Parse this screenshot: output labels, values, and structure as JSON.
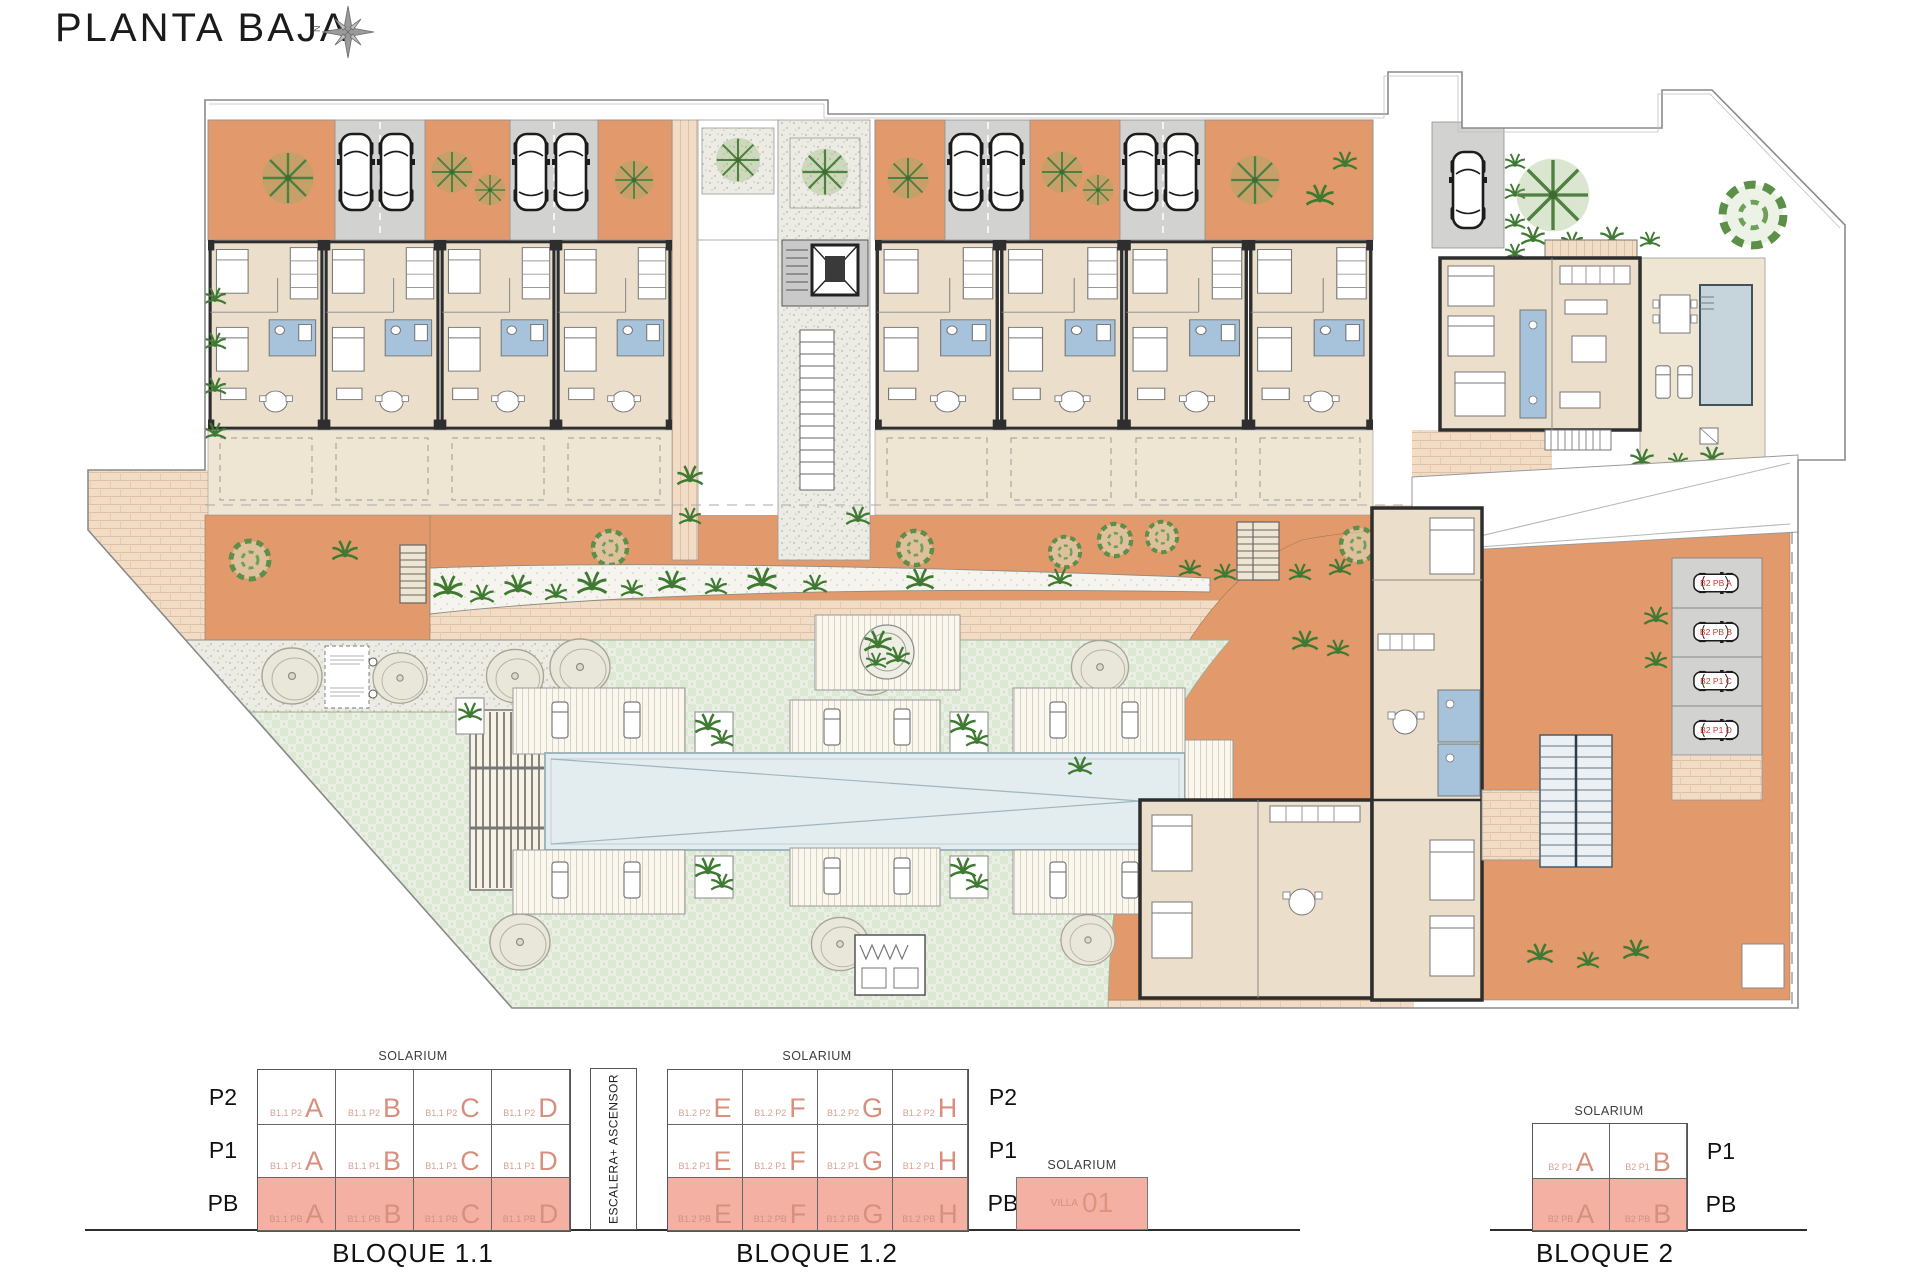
{
  "header": {
    "title": "PLANTA BAJA",
    "compass": "N"
  },
  "site": {
    "parking_labels": [
      "B2 PB A",
      "B2 PB B",
      "B2 P1 C",
      "B2 P1 D"
    ]
  },
  "legend": {
    "solarium": "SOLARIUM",
    "escalera": "ESCALERA+ ASCENSOR",
    "floors": {
      "p2": "P2",
      "p1": "P1",
      "pb": "PB"
    },
    "bloque11": {
      "title": "BLOQUE 1.1",
      "rows": [
        {
          "floor": "P2",
          "cells": [
            {
              "code": "B1.1 P2",
              "letter": "A"
            },
            {
              "code": "B1.1 P2",
              "letter": "B"
            },
            {
              "code": "B1.1 P2",
              "letter": "C"
            },
            {
              "code": "B1.1 P2",
              "letter": "D"
            }
          ]
        },
        {
          "floor": "P1",
          "cells": [
            {
              "code": "B1.1 P1",
              "letter": "A"
            },
            {
              "code": "B1.1 P1",
              "letter": "B"
            },
            {
              "code": "B1.1 P1",
              "letter": "C"
            },
            {
              "code": "B1.1 P1",
              "letter": "D"
            }
          ]
        },
        {
          "floor": "PB",
          "cells": [
            {
              "code": "B1.1 PB",
              "letter": "A"
            },
            {
              "code": "B1.1 PB",
              "letter": "B"
            },
            {
              "code": "B1.1 PB",
              "letter": "C"
            },
            {
              "code": "B1.1 PB",
              "letter": "D"
            }
          ]
        }
      ]
    },
    "bloque12": {
      "title": "BLOQUE 1.2",
      "rows": [
        {
          "floor": "P2",
          "cells": [
            {
              "code": "B1.2 P2",
              "letter": "E"
            },
            {
              "code": "B1.2 P2",
              "letter": "F"
            },
            {
              "code": "B1.2 P2",
              "letter": "G"
            },
            {
              "code": "B1.2 P2",
              "letter": "H"
            }
          ]
        },
        {
          "floor": "P1",
          "cells": [
            {
              "code": "B1.2 P1",
              "letter": "E"
            },
            {
              "code": "B1.2 P1",
              "letter": "F"
            },
            {
              "code": "B1.2 P1",
              "letter": "G"
            },
            {
              "code": "B1.2 P1",
              "letter": "H"
            }
          ]
        },
        {
          "floor": "PB",
          "cells": [
            {
              "code": "B1.2 PB",
              "letter": "E"
            },
            {
              "code": "B1.2 PB",
              "letter": "F"
            },
            {
              "code": "B1.2 PB",
              "letter": "G"
            },
            {
              "code": "B1.2 PB",
              "letter": "H"
            }
          ]
        }
      ]
    },
    "villa": {
      "name": "VILLA",
      "number": "01"
    },
    "bloque2": {
      "title": "BLOQUE 2",
      "rows": [
        {
          "floor": "P1",
          "cells": [
            {
              "code": "B2 P1",
              "letter": "A"
            },
            {
              "code": "B2 P1",
              "letter": "B"
            }
          ]
        },
        {
          "floor": "PB",
          "cells": [
            {
              "code": "B2 PB",
              "letter": "A"
            },
            {
              "code": "B2 PB",
              "letter": "B"
            }
          ]
        }
      ]
    }
  }
}
